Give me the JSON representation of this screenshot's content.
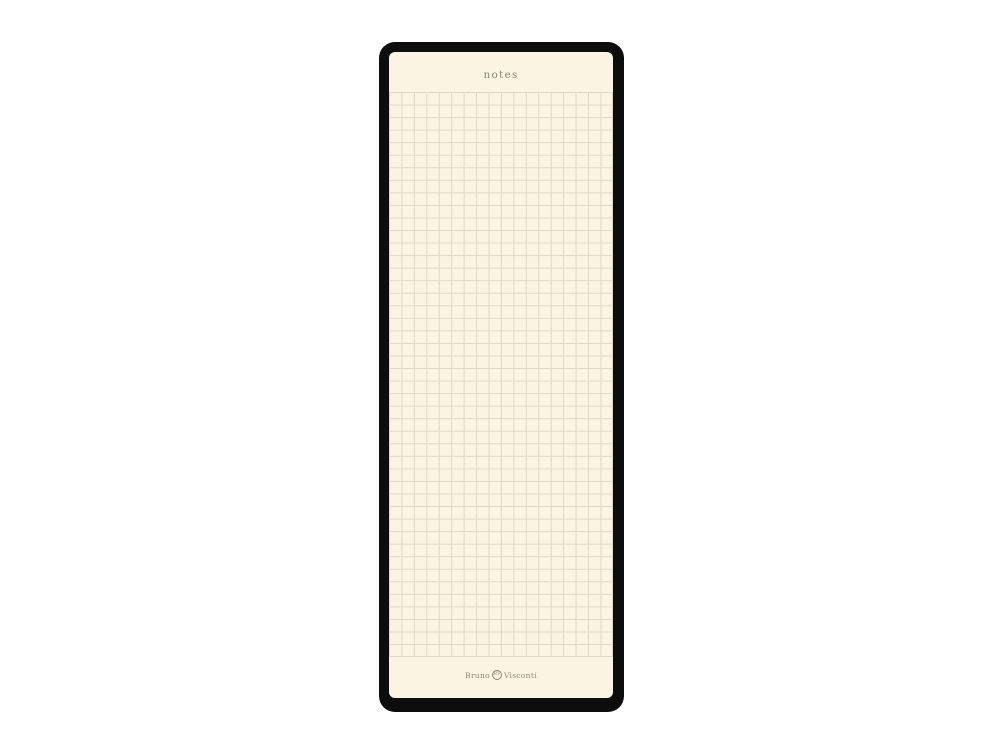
{
  "page": {
    "title": "notes"
  },
  "grid": {
    "columns": 18,
    "rows": 45,
    "style": "squared"
  },
  "brand": {
    "first": "Bruno",
    "monogram": "BV",
    "second": "Visconti"
  },
  "colors": {
    "backdrop": "#ffffff",
    "frame": "#0d0d0d",
    "paper": "#fbf4e3",
    "grid-line": "#ded8c6",
    "ink": "#8e8779"
  }
}
